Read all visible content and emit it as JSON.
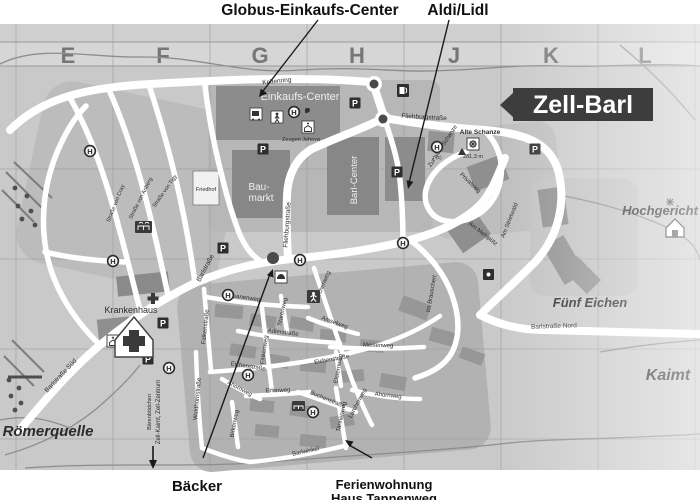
{
  "callouts": {
    "globus": "Globus-Einkaufs-Center",
    "aldi_lidl": "Aldi/Lidl",
    "baecker": "Bäcker",
    "ferienwohnung": "Ferienwohnung",
    "haus_tannenweg": "Haus Tannenweg"
  },
  "banner": {
    "label": "Zell-Barl",
    "bg": "#3d3d3d",
    "fg": "#ffffff"
  },
  "grid_letters": [
    "E",
    "F",
    "G",
    "H",
    "J",
    "K",
    "L"
  ],
  "icons": {
    "parking": "P",
    "bus_stop": "H"
  },
  "places": {
    "einkaufs_center": "Einkaufs-Center",
    "baumarkt_line1": "Bau-",
    "baumarkt_line2": "markt",
    "barl_center": "Barl-Center",
    "friedhof": "Friedhof",
    "krankenhaus": "Krankenhaus",
    "zeugen_jehova": "Zeugen Jehova",
    "alte_schanze": "Alte Schanze",
    "elevation": "281,3 m",
    "bus_route": "1 (1)",
    "roemerquelle": "Römerquelle",
    "fuenf_eichen": "Fünf Eichen",
    "hochgericht": "Hochgericht",
    "kaimt": "Kaimt"
  },
  "direction_sign": {
    "line1": "Bärenbödchen",
    "line2": "Zell-Kaimt, Zell-Zentrum"
  },
  "streets": [
    {
      "name": "Keltenring"
    },
    {
      "name": "Fliehburgstraße"
    },
    {
      "name": "Fliehburgstraße"
    },
    {
      "name": "Zur alten Schanze"
    },
    {
      "name": "Privatweg"
    },
    {
      "name": "Am Mehlpütz"
    },
    {
      "name": "Am Strietwald"
    },
    {
      "name": "Im Brauschert"
    },
    {
      "name": "Barlstraße"
    },
    {
      "name": "Barlstraße Süd"
    },
    {
      "name": "Barlstraße Nord"
    },
    {
      "name": "Straße von Tigy"
    },
    {
      "name": "Straße von Anberg"
    },
    {
      "name": "Straße von Cray"
    },
    {
      "name": "Fasanenweg"
    },
    {
      "name": "Falkenstraße"
    },
    {
      "name": "Waldhornstraße"
    },
    {
      "name": "Adlerstraße"
    },
    {
      "name": "Finkenweg"
    },
    {
      "name": "Starenweg"
    },
    {
      "name": "Amselweg"
    },
    {
      "name": "Meisenweg"
    },
    {
      "name": "Eichenstraße"
    },
    {
      "name": "Eichenstraße"
    },
    {
      "name": "Erlenweg"
    },
    {
      "name": "Buchenstraße"
    },
    {
      "name": "Ahornweg"
    },
    {
      "name": "Ahornweg"
    },
    {
      "name": "Lärchenweg"
    },
    {
      "name": "Lärchenweg"
    },
    {
      "name": "Elsternweg"
    },
    {
      "name": "Tannenweg"
    },
    {
      "name": "Birkenweg"
    },
    {
      "name": "Barlwinkel"
    }
  ],
  "colors": {
    "map_base": "#c9c9c9",
    "zone": "#b3b3b3",
    "building": "#8c8c8c",
    "road": "#ffffff",
    "label_dark": "#2d2d2d"
  }
}
